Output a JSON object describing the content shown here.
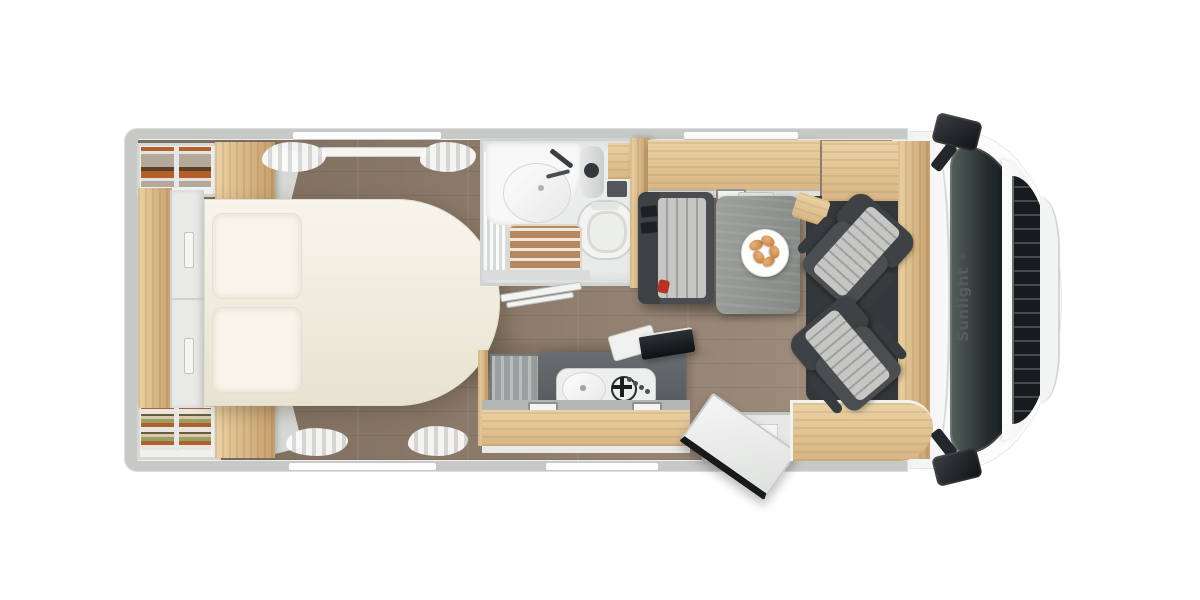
{
  "meta": {
    "title": "Sunlight motorhome floor plan - top view"
  },
  "branding": {
    "label": "Sunlight",
    "sun_icon": "✳"
  },
  "counts": {
    "swivel_cab_seats": 2,
    "pillows": 2,
    "wardrobes": 2,
    "wall_window_slots": 4,
    "hob_knobs": 4,
    "plate_croissants": 5,
    "side_mirrors": 2
  },
  "rooms": [
    "bedroom",
    "bathroom",
    "kitchen",
    "dinette",
    "cab"
  ],
  "colors": {
    "bg": "#ffffff",
    "wall": "#c6c9c6",
    "floorA": "#8b7a6a",
    "floorB": "#a29080",
    "floorDark": "#7b6b5c",
    "oak": "#d8b584",
    "oakLight": "#ead2a4",
    "oakDeep": "#c79f6d",
    "bed": "#eeeadb",
    "pillow": "#f7f5ec",
    "seatDark": "#3f4244",
    "stripeA": "#c6c7c5",
    "stripeB": "#9fa09e",
    "tableA": "#9da19e",
    "tableB": "#838784",
    "showerWood": "#b5885f",
    "showerSlat": "#f0e8dc",
    "cooktop": "#edefee",
    "cabFloor": "#35383a",
    "grille": "#181b1e",
    "red": "#b83226",
    "croissA": "#e5b079",
    "croissB": "#c07a38"
  }
}
